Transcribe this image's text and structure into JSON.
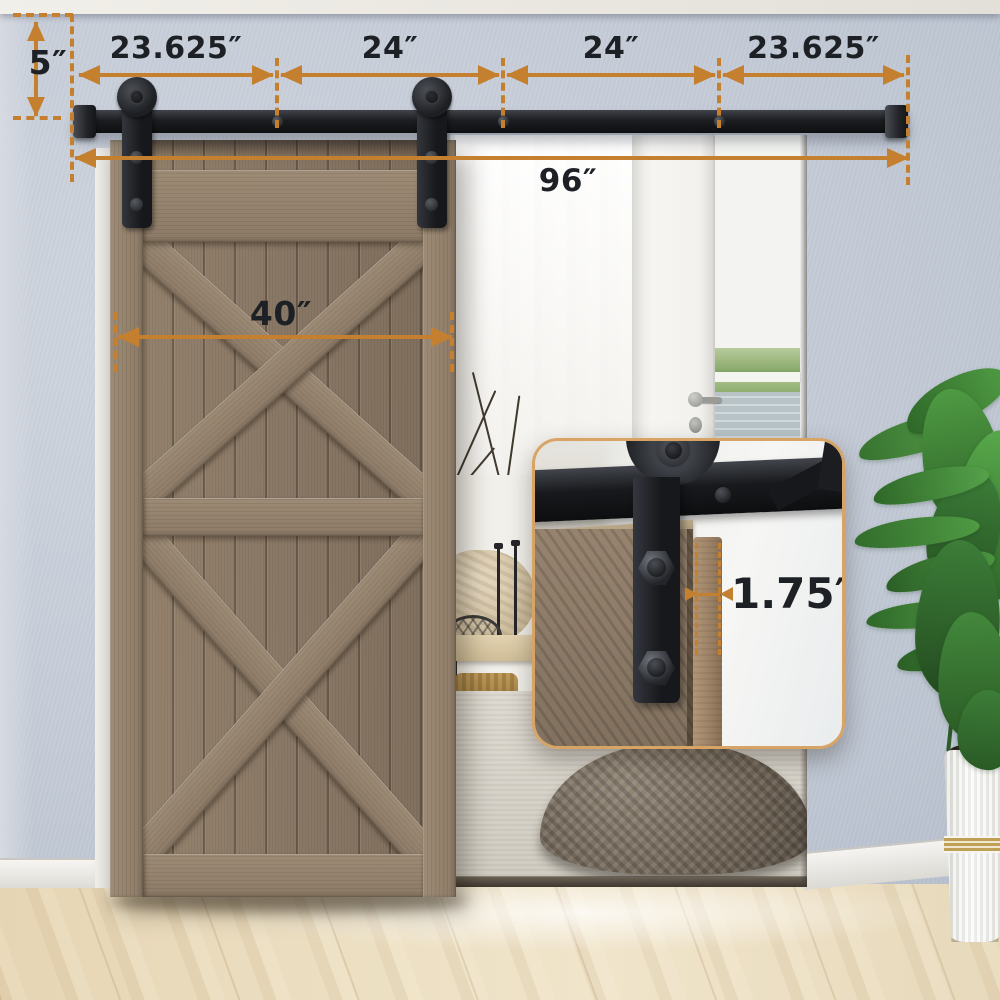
{
  "dimensions": {
    "top_segments": [
      "23.625″",
      "24″",
      "24″",
      "23.625″"
    ],
    "track_total": "96″",
    "door_width": "40″",
    "top_offset": "5″",
    "door_thickness": "1.75″"
  },
  "colors": {
    "dimension_accent": "#c5802f",
    "label_text": "#1d2126",
    "hardware_black": "#202227",
    "wall_blue_gray": "#c6cdd8",
    "door_wood": "#8d7b6a",
    "floor_wood": "#e9dcc0",
    "inset_border": "#d8a466",
    "curtain_white": "#f6f4f1",
    "plant_green": "#3c7d38",
    "pot_white": "#f4f4f1"
  }
}
